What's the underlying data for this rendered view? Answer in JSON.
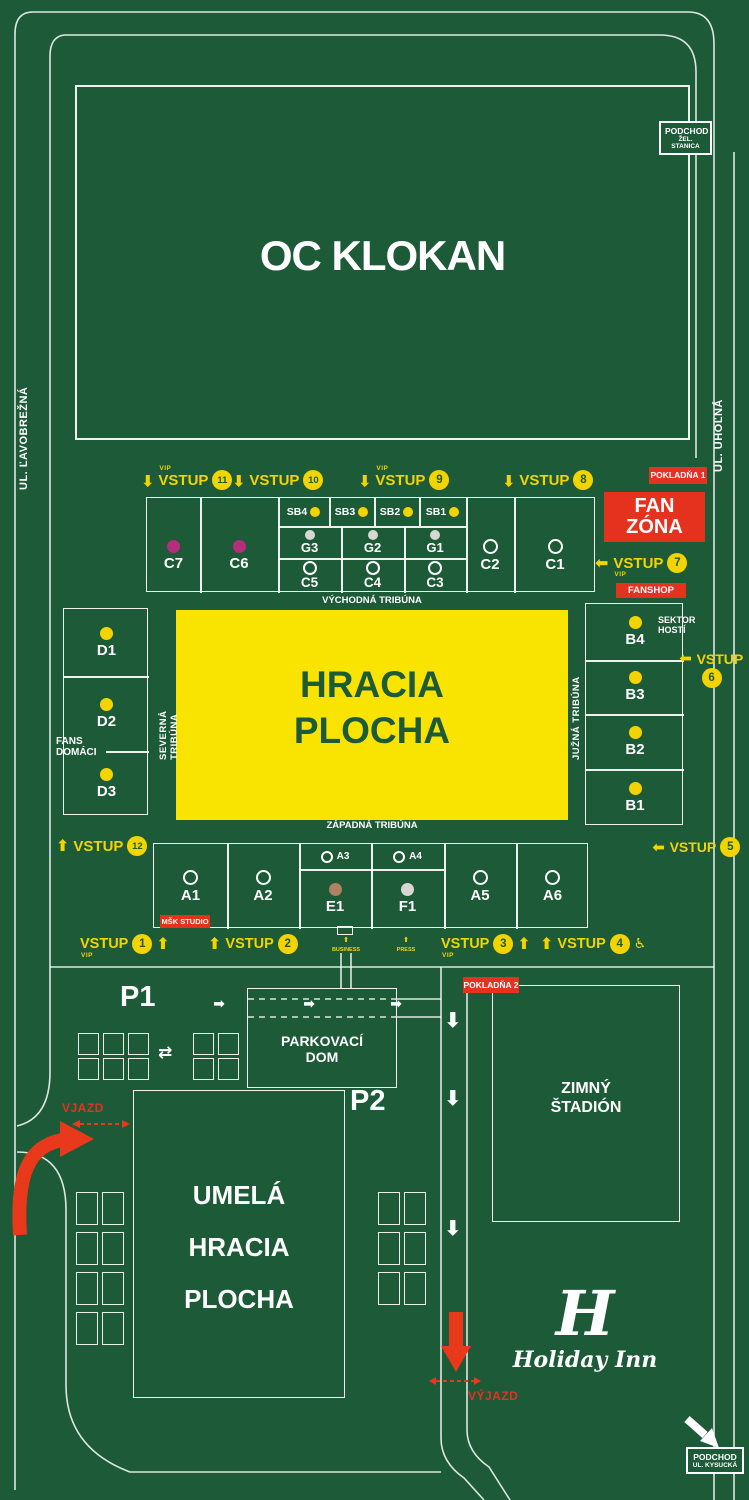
{
  "colors": {
    "background": "#1d5a37",
    "accent_yellow": "#f3d400",
    "pitch_yellow": "#f9e300",
    "accent_red": "#e5321f",
    "arrow_red": "#e8391c",
    "magenta": "#b62d7d",
    "brown": "#b08163",
    "light_gray": "#d8d8d3"
  },
  "icons": {
    "arrow": "⬆",
    "swap_arrows": "⇄",
    "wheelchair": "♿"
  },
  "streets": {
    "left": "UL. ĽAVOBREŽNÁ",
    "right": "UL. UHOĽNÁ"
  },
  "podchody": {
    "station": {
      "line1": "PODCHOD",
      "line2": "ŽEL. STANICA"
    },
    "kysucka": {
      "line1": "PODCHOD",
      "line2": "UL. KYSUCKÁ"
    }
  },
  "buildings": {
    "oc_klokan": "OC KLOKAN",
    "zimny_stadion": {
      "line1": "ZIMNÝ",
      "line2": "ŠTADIÓN"
    },
    "parkovaci_dom": {
      "line1": "PARKOVACÍ",
      "line2": "DOM"
    },
    "umela_plocha": {
      "line1": "UMELÁ",
      "line2": "HRACIA",
      "line3": "PLOCHA"
    },
    "holiday_inn": {
      "monogram": "H",
      "name": "Holiday Inn"
    }
  },
  "parking": {
    "p1": "P1",
    "p2": "P2"
  },
  "facilities": {
    "fan_zona": "FAN ZÓNA",
    "fanshop": "FANSHOP",
    "pokladna1": "POKLADŇA 1",
    "pokladna2": "POKLADŇA 2",
    "msk_studio": "MŠK STUDIO"
  },
  "traffic": {
    "vjazd": "VJAZD",
    "vyjazd": "VÝJAZD"
  },
  "pitch": {
    "line1": "HRACIA",
    "line2": "PLOCHA"
  },
  "tribunes": {
    "east": "VÝCHODNÁ TRIBÚNA",
    "west": "ZÁPADNÁ TRIBÚNA",
    "north": "SEVERNÁ TRIBÚNA",
    "south": "JUŽNÁ TRIBÚNA"
  },
  "zones": {
    "fans_home": {
      "line1": "FANS",
      "line2": "DOMÁCI"
    },
    "guests": {
      "line1": "SEKTOR",
      "line2": "HOSTÍ"
    }
  },
  "gates": {
    "word": "VSTUP",
    "vip": "VIP",
    "business": "BUSINESS",
    "press": "PRESS",
    "nums": {
      "1": "1",
      "2": "2",
      "3": "3",
      "4": "4",
      "5": "5",
      "6": "6",
      "7": "7",
      "8": "8",
      "9": "9",
      "10": "10",
      "11": "11",
      "12": "12"
    }
  },
  "sectors": {
    "east": {
      "c7": "C7",
      "c6": "C6",
      "sb": [
        "SB4",
        "SB3",
        "SB2",
        "SB1"
      ],
      "g": [
        "G3",
        "G2",
        "G1"
      ],
      "c_mid": [
        "C5",
        "C4",
        "C3"
      ],
      "c2": "C2",
      "c1": "C1"
    },
    "north": [
      "D1",
      "D2",
      "D3"
    ],
    "south": [
      "B4",
      "B3",
      "B2",
      "B1"
    ],
    "west": {
      "a1": "A1",
      "a2": "A2",
      "a3": "A3",
      "a4": "A4",
      "e1": "E1",
      "f1": "F1",
      "a5": "A5",
      "a6": "A6"
    }
  }
}
